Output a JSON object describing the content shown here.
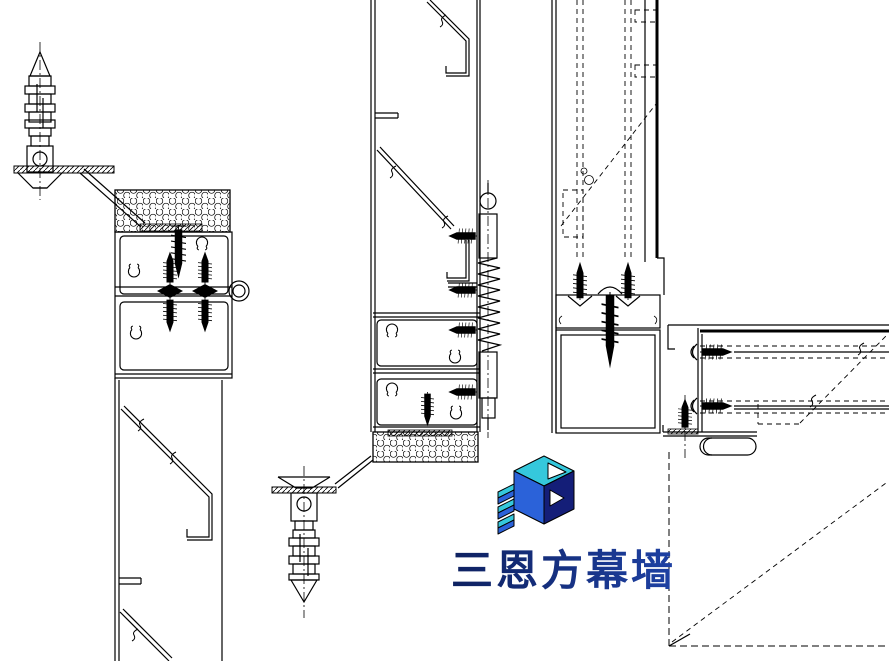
{
  "page": {
    "background": "#FFFFFF"
  },
  "drawing": {
    "line_color": "#000000",
    "details": [
      {
        "id": "left-mullion-section"
      },
      {
        "id": "middle-mullion-section"
      },
      {
        "id": "corner-vertical-section"
      },
      {
        "id": "corner-horizontal-section"
      }
    ]
  },
  "logo": {
    "text": "三恩方幕墙",
    "mark": "3n-cube-logo",
    "colors": {
      "top": "#35C8DC",
      "front": "#2B62D9",
      "side": "#141E78",
      "white": "#FFFFFF",
      "text_start": "#0E2160",
      "text_end": "#1E41A4"
    }
  }
}
